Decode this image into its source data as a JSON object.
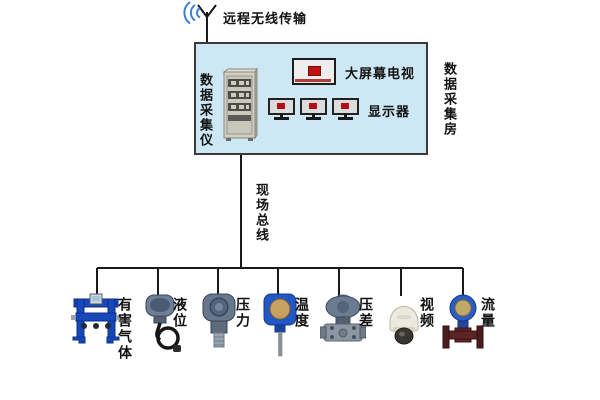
{
  "title": "数据采集系统结构图",
  "wireless": {
    "label": "远程无线传输"
  },
  "room": {
    "label": "数据采集房",
    "daq_cabinet": {
      "label": "数据采集仪"
    },
    "big_screen_tv": {
      "label": "大屏幕电视"
    },
    "monitors": {
      "label": "显示器",
      "count": 3
    }
  },
  "fieldbus": {
    "label": "现场总线"
  },
  "devices": [
    {
      "id": "harmful-gas",
      "label": "有害气体"
    },
    {
      "id": "liquid-level",
      "label": "液位"
    },
    {
      "id": "pressure",
      "label": "压力"
    },
    {
      "id": "temperature",
      "label": "温度"
    },
    {
      "id": "diff-pressure",
      "label": "压差"
    },
    {
      "id": "video",
      "label": "视频"
    },
    {
      "id": "flow",
      "label": "流量"
    }
  ],
  "icons": {
    "antenna": "antenna-icon",
    "wireless_waves": "wireless-waves-icon",
    "cabinet": "daq-cabinet-icon",
    "tv": "big-screen-tv-icon",
    "monitor": "monitor-icon"
  },
  "colors": {
    "room_fill": "#cde7f5",
    "room_border": "#3a3a3a",
    "line": "#1a1a1a",
    "wave_blue": "#3b7fd4",
    "device_blue": "#2257c4",
    "transmitter_grey": "#68788c",
    "flow_pipe_maroon": "#552222",
    "tv_logo_red": "#c01212",
    "cabinet_beige": "#d2cfc4",
    "camera_white": "#eceadf"
  }
}
